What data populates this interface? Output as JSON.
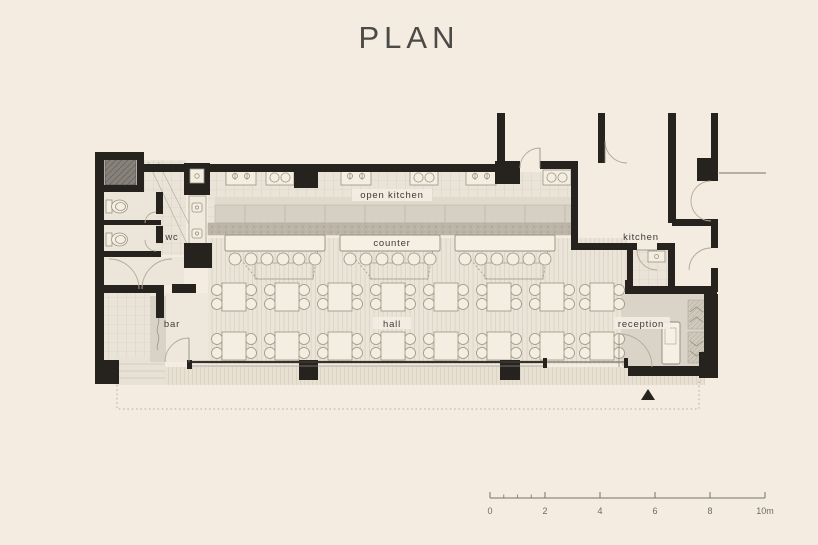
{
  "title": "PLAN",
  "labels": {
    "open_kitchen": "open kitchen",
    "counter": "counter",
    "wc": "wc",
    "bar": "bar",
    "hall": "hall",
    "kitchen": "kitchen",
    "reception": "reception"
  },
  "scale_bar": {
    "ticks": [
      "0",
      "2",
      "4",
      "6",
      "8",
      "10m"
    ]
  },
  "colors": {
    "background": "#f4ebe1",
    "walls": "#26231f",
    "floor_wood": "#ebe4d8",
    "floor_tile": "#eae3d8",
    "counter_strip": "#bcb5a7",
    "label_text": "#3e3c37"
  }
}
